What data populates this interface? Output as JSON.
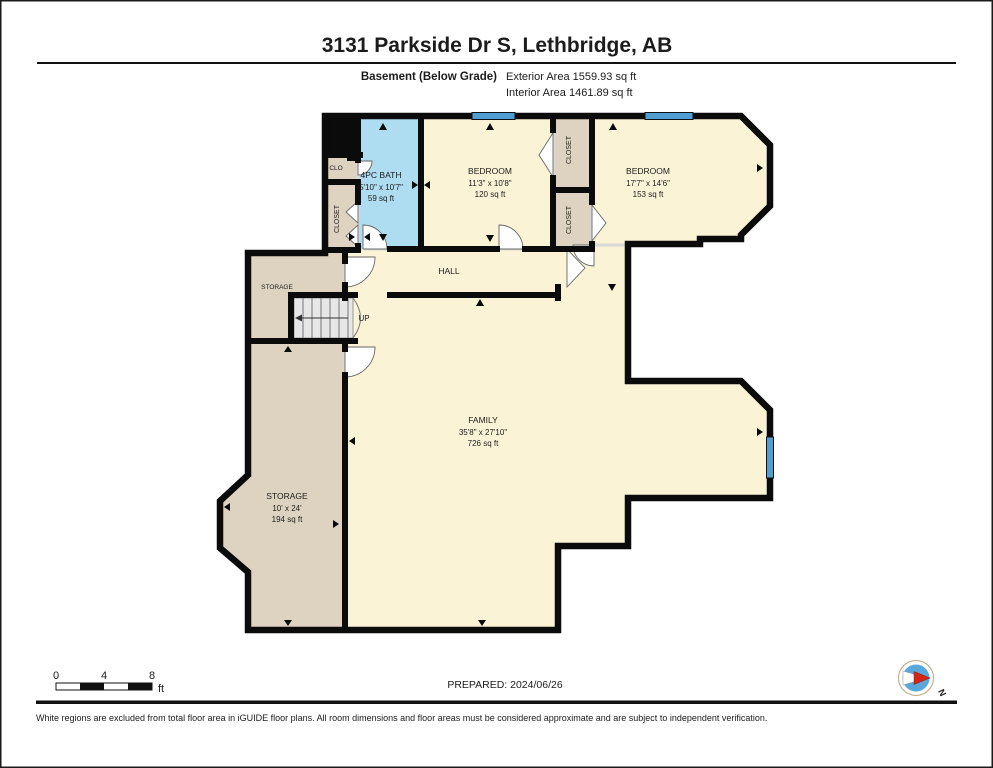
{
  "header": {
    "title": "3131 Parkside Dr S, Lethbridge, AB",
    "floor_label": "Basement (Below Grade)",
    "exterior_area": "Exterior Area 1559.93 sq ft",
    "interior_area": "Interior Area 1461.89 sq ft"
  },
  "rooms": {
    "bath": {
      "name": "4PC BATH",
      "dims": "5'10\" x 10'7\"",
      "area": "59 sq ft"
    },
    "bedroom1": {
      "name": "BEDROOM",
      "dims": "11'3\" x 10'8\"",
      "area": "120 sq ft"
    },
    "bedroom2": {
      "name": "BEDROOM",
      "dims": "17'7\" x 14'6\"",
      "area": "153 sq ft"
    },
    "hall": {
      "name": "HALL"
    },
    "family": {
      "name": "FAMILY",
      "dims": "35'8\" x 27'10\"",
      "area": "726 sq ft"
    },
    "storage_small": {
      "name": "STORAGE"
    },
    "storage": {
      "name": "STORAGE",
      "dims": "10' x 24'",
      "area": "194 sq ft"
    },
    "clo": {
      "name": "CLO"
    },
    "closet_left": {
      "name": "CLOSET"
    },
    "closet_top": {
      "name": "CLOSET"
    },
    "closet_bottom": {
      "name": "CLOSET"
    },
    "stairs": {
      "direction_label": "UP"
    }
  },
  "scale_bar": {
    "tick_0": "0",
    "tick_4": "4",
    "tick_8": "8",
    "unit": "ft"
  },
  "compass": {
    "north_label": "N"
  },
  "footer": {
    "prepared": "PREPARED: 2024/06/26",
    "disclaimer": "White regions are excluded from total floor area in iGUIDE floor plans. All room dimensions and floor areas must be considered approximate and are subject to independent verification."
  },
  "colors": {
    "room_fill": "#fbf3d5",
    "closet_fill": "#ded3c0",
    "bath_fill": "#aedcf0",
    "stairs_fill": "#e7e7e7",
    "window_blue": "#4f9fd4",
    "wall": "#0b0b0b",
    "compass_blue": "#5aa8da",
    "compass_red": "#d62418"
  }
}
